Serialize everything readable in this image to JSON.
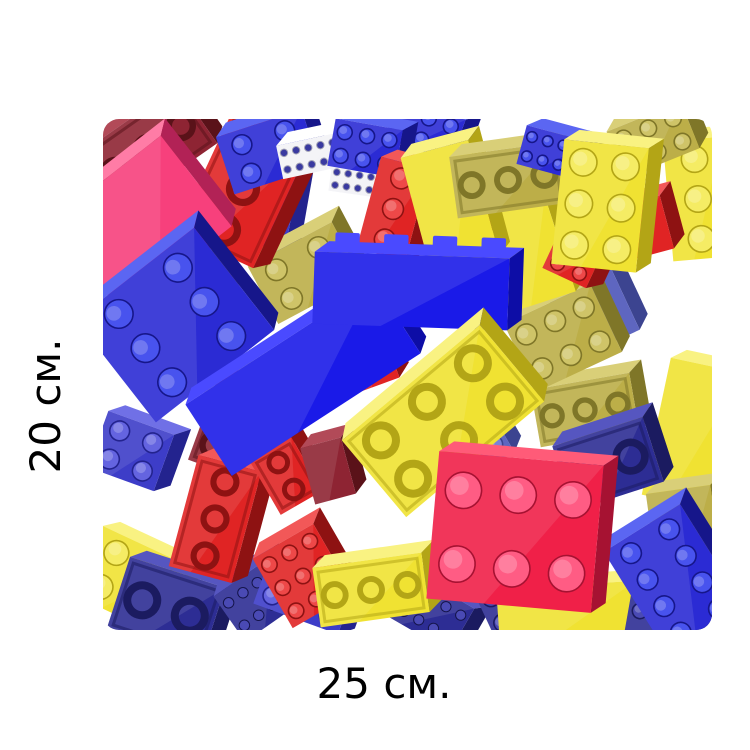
{
  "labels": {
    "height": "20 см.",
    "width": "25 см."
  },
  "figure": {
    "description": "pile of scattered red, blue, yellow and pink toy building bricks on white",
    "background": "#ffffff",
    "width": 609,
    "height": 511,
    "corner_radius": 16,
    "palette": {
      "blue": {
        "front": "#2b2bd4",
        "top": "#5b66f2",
        "side": "#16168a",
        "stud": "#4853ee",
        "dark": "#101078"
      },
      "blueBright": {
        "front": "#1a1ae8",
        "top": "#4a4aff",
        "side": "#0d0da6",
        "stud": "#3d3dff",
        "dark": "#0a0a86"
      },
      "blueMid": {
        "front": "#3d3dc8",
        "top": "#7070e6",
        "side": "#23238e",
        "stud": "#6464e0",
        "dark": "#1a1a70"
      },
      "blueDark": {
        "front": "#2d2d94",
        "top": "#5656c0",
        "side": "#1b1b60",
        "stud": "#4a4ab4",
        "dark": "#14144a"
      },
      "blueMuted": {
        "front": "#5e66c0",
        "top": "#8d94e0",
        "side": "#3c4490",
        "stud": "#7a82d6",
        "dark": "#2c3472"
      },
      "red": {
        "front": "#e02424",
        "top": "#f25858",
        "side": "#8e1212",
        "stud": "#ee4848",
        "dark": "#760c0c"
      },
      "maroon": {
        "front": "#8e2433",
        "top": "#b24a58",
        "side": "#5a1219",
        "stud": "#a43a48",
        "dark": "#470d13"
      },
      "crimson": {
        "front": "#f02048",
        "top": "#ff5b78",
        "side": "#a61232",
        "stud": "#ff5c84",
        "dark": "#8a0e28"
      },
      "pink": {
        "front": "#f7407c",
        "top": "#ff7ca6",
        "side": "#b22256",
        "stud": "#ff6b98",
        "dark": "#921c46"
      },
      "yellow": {
        "front": "#f0e232",
        "top": "#f9f282",
        "side": "#b3a516",
        "stud": "#f5ec64",
        "dark": "#8e8410"
      },
      "olive": {
        "front": "#bcae48",
        "top": "#d9cf78",
        "side": "#7f7628",
        "stud": "#cfc468",
        "dark": "#655d1e"
      },
      "white": {
        "front": "#f3f3f7",
        "top": "#ffffff",
        "side": "#c9c9d6",
        "stud": "#3a3aa0",
        "dark": "#a0a0b4"
      }
    },
    "bricks": [
      {
        "x": 27,
        "y": 461,
        "w": 95,
        "h": 75,
        "r": 25,
        "c": "yellow",
        "t": "top",
        "s": [
          2,
          2
        ]
      },
      {
        "x": 63,
        "y": 489,
        "w": 100,
        "h": 75,
        "r": 18,
        "c": "blueDark",
        "t": "bottom",
        "s": [
          2,
          1
        ]
      },
      {
        "x": 155,
        "y": 480,
        "w": 70,
        "h": 55,
        "r": -35,
        "c": "blueDark",
        "t": "studrows",
        "s": [
          4,
          2
        ]
      },
      {
        "x": 202,
        "y": 474,
        "w": 90,
        "h": 55,
        "r": 20,
        "c": "blueMid",
        "t": "top",
        "s": [
          3,
          2
        ]
      },
      {
        "x": 322,
        "y": 490,
        "w": 85,
        "h": 50,
        "r": 30,
        "c": "blueDark",
        "t": "studrows",
        "s": [
          5,
          2
        ]
      },
      {
        "x": 418,
        "y": 480,
        "w": 80,
        "h": 55,
        "r": -25,
        "c": "blueDark",
        "t": "top",
        "s": [
          3,
          2
        ]
      },
      {
        "x": 465,
        "y": 494,
        "w": 140,
        "h": 55,
        "r": -4,
        "c": "yellow",
        "t": "plain"
      },
      {
        "x": 560,
        "y": 496,
        "w": 70,
        "h": 45,
        "r": 10,
        "c": "blueDark",
        "t": "top",
        "s": [
          3,
          1
        ]
      },
      {
        "x": 28,
        "y": 332,
        "w": 70,
        "h": 60,
        "r": 20,
        "c": "blueMid",
        "t": "top",
        "s": [
          2,
          2
        ]
      },
      {
        "x": 140,
        "y": 300,
        "w": 55,
        "h": 75,
        "r": -25,
        "c": "yellow",
        "t": "plain"
      },
      {
        "x": 590,
        "y": 315,
        "w": 75,
        "h": 140,
        "r": 12,
        "c": "yellow",
        "t": "plain"
      },
      {
        "x": 582,
        "y": 420,
        "w": 65,
        "h": 100,
        "r": -8,
        "c": "olive",
        "t": "plain"
      },
      {
        "x": 482,
        "y": 291,
        "w": 100,
        "h": 58,
        "r": -10,
        "c": "olive",
        "t": "bottom",
        "s": [
          3,
          1
        ]
      },
      {
        "x": 487,
        "y": 187,
        "w": 70,
        "h": 85,
        "r": -25,
        "c": "blueMuted",
        "t": "plain"
      },
      {
        "x": 460,
        "y": 219,
        "w": 95,
        "h": 75,
        "r": -25,
        "c": "olive",
        "t": "top",
        "s": [
          3,
          2
        ]
      },
      {
        "x": 368,
        "y": 318,
        "w": 60,
        "h": 70,
        "r": -30,
        "c": "blueMuted",
        "t": "top",
        "s": [
          2,
          2
        ]
      },
      {
        "x": 423,
        "y": 136,
        "w": 72,
        "h": 100,
        "r": -18,
        "c": "yellow",
        "t": "plain"
      },
      {
        "x": 368,
        "y": 77,
        "w": 40,
        "h": 70,
        "r": 25,
        "c": "red",
        "t": "plain"
      },
      {
        "x": 322,
        "y": 10,
        "w": 70,
        "h": 45,
        "r": 20,
        "c": "blue",
        "t": "top",
        "s": [
          3,
          2
        ]
      },
      {
        "x": 595,
        "y": 80,
        "w": 60,
        "h": 120,
        "r": -5,
        "c": "yellow",
        "t": "top",
        "s": [
          1,
          3
        ]
      },
      {
        "x": 530,
        "y": 112,
        "w": 70,
        "h": 55,
        "r": -15,
        "c": "red",
        "t": "plain"
      },
      {
        "x": 470,
        "y": 140,
        "w": 48,
        "h": 42,
        "r": 25,
        "c": "red",
        "t": "top",
        "s": [
          2,
          2
        ]
      },
      {
        "x": 167,
        "y": 88,
        "w": 45,
        "h": 110,
        "r": 10,
        "c": "blueMid",
        "t": "plain"
      },
      {
        "x": 82,
        "y": 138,
        "w": 55,
        "h": 110,
        "r": -20,
        "c": "yellow",
        "t": "plain"
      },
      {
        "x": 202,
        "y": 154,
        "w": 95,
        "h": 65,
        "r": -28,
        "c": "olive",
        "t": "top",
        "s": [
          2,
          2
        ]
      },
      {
        "x": 265,
        "y": 238,
        "w": 45,
        "h": 60,
        "r": -20,
        "c": "red",
        "t": "plain"
      },
      {
        "x": 45,
        "y": 30,
        "w": 120,
        "h": 70,
        "r": -35,
        "c": "maroon",
        "t": "bottom",
        "s": [
          3,
          1
        ]
      },
      {
        "x": 140,
        "y": 70,
        "w": 85,
        "h": 135,
        "r": 25,
        "c": "red",
        "t": "bottom",
        "s": [
          1,
          3
        ]
      },
      {
        "x": 165,
        "y": 33,
        "w": 90,
        "h": 60,
        "r": -18,
        "c": "blue",
        "t": "top",
        "s": [
          2,
          2
        ]
      },
      {
        "x": 207,
        "y": 37,
        "w": 62,
        "h": 34,
        "r": -12,
        "c": "white",
        "t": "studrows",
        "s": [
          5,
          2
        ]
      },
      {
        "x": 250,
        "y": 62,
        "w": 46,
        "h": 26,
        "r": 8,
        "c": "white",
        "t": "studrows",
        "s": [
          4,
          2
        ]
      },
      {
        "x": 262,
        "y": 29,
        "w": 68,
        "h": 48,
        "r": 10,
        "c": "blue",
        "t": "top",
        "s": [
          3,
          2
        ]
      },
      {
        "x": 290,
        "y": 90,
        "w": 50,
        "h": 95,
        "r": 15,
        "c": "red",
        "t": "top",
        "s": [
          1,
          3
        ]
      },
      {
        "x": 347,
        "y": 88,
        "w": 70,
        "h": 120,
        "r": -15,
        "c": "yellow",
        "t": "plain"
      },
      {
        "x": 405,
        "y": 61,
        "w": 110,
        "h": 62,
        "r": -8,
        "c": "olive",
        "t": "bottom",
        "s": [
          3,
          1
        ]
      },
      {
        "x": 450,
        "y": 34,
        "w": 65,
        "h": 40,
        "r": 15,
        "c": "blue",
        "t": "top",
        "s": [
          4,
          2
        ]
      },
      {
        "x": 550,
        "y": 21,
        "w": 80,
        "h": 50,
        "r": -22,
        "c": "olive",
        "t": "top",
        "s": [
          3,
          2
        ]
      },
      {
        "x": 497,
        "y": 87,
        "w": 85,
        "h": 125,
        "r": 6,
        "c": "yellow",
        "t": "top",
        "s": [
          2,
          3
        ]
      },
      {
        "x": 38,
        "y": 105,
        "w": 140,
        "h": 115,
        "r": -38,
        "c": "pink",
        "t": "plain"
      },
      {
        "x": 72,
        "y": 206,
        "w": 150,
        "h": 130,
        "r": -38,
        "c": "blue",
        "t": "top",
        "s": [
          2,
          3
        ]
      },
      {
        "x": 138,
        "y": 312,
        "w": 80,
        "h": 90,
        "r": 20,
        "c": "maroon",
        "t": "bottom",
        "s": [
          2,
          2
        ]
      },
      {
        "x": 112,
        "y": 400,
        "w": 65,
        "h": 115,
        "r": 15,
        "c": "red",
        "t": "bottom",
        "s": [
          1,
          3
        ]
      },
      {
        "x": 183,
        "y": 357,
        "w": 48,
        "h": 62,
        "r": -30,
        "c": "red",
        "t": "bottom",
        "s": [
          1,
          2
        ]
      },
      {
        "x": 225,
        "y": 352,
        "w": 42,
        "h": 58,
        "r": -15,
        "c": "maroon",
        "t": "plain"
      },
      {
        "x": 200,
        "y": 457,
        "w": 70,
        "h": 80,
        "r": -30,
        "c": "red",
        "t": "top",
        "s": [
          3,
          3
        ]
      },
      {
        "x": 268,
        "y": 471,
        "w": 110,
        "h": 60,
        "r": -8,
        "c": "yellow",
        "t": "bottom",
        "s": [
          3,
          1
        ]
      },
      {
        "x": 505,
        "y": 345,
        "w": 95,
        "h": 68,
        "r": -18,
        "c": "blueDark",
        "t": "bottom",
        "s": [
          2,
          1
        ]
      },
      {
        "x": 572,
        "y": 462,
        "w": 90,
        "h": 125,
        "r": -32,
        "c": "blue",
        "t": "top",
        "s": [
          2,
          4
        ]
      },
      {
        "x": 200,
        "y": 260,
        "w": 225,
        "h": 85,
        "r": -33,
        "c": "blueBright",
        "t": "plain"
      },
      {
        "x": 308,
        "y": 172,
        "w": 195,
        "h": 72,
        "r": 2,
        "c": "blueBright",
        "t": "sidestud",
        "s": [
          4,
          1
        ]
      },
      {
        "x": 340,
        "y": 302,
        "w": 180,
        "h": 100,
        "r": -40,
        "c": "yellow",
        "t": "bottom",
        "s": [
          3,
          2
        ]
      },
      {
        "x": 412,
        "y": 413,
        "w": 165,
        "h": 148,
        "r": 5,
        "c": "crimson",
        "t": "top",
        "s": [
          3,
          2
        ]
      }
    ]
  }
}
